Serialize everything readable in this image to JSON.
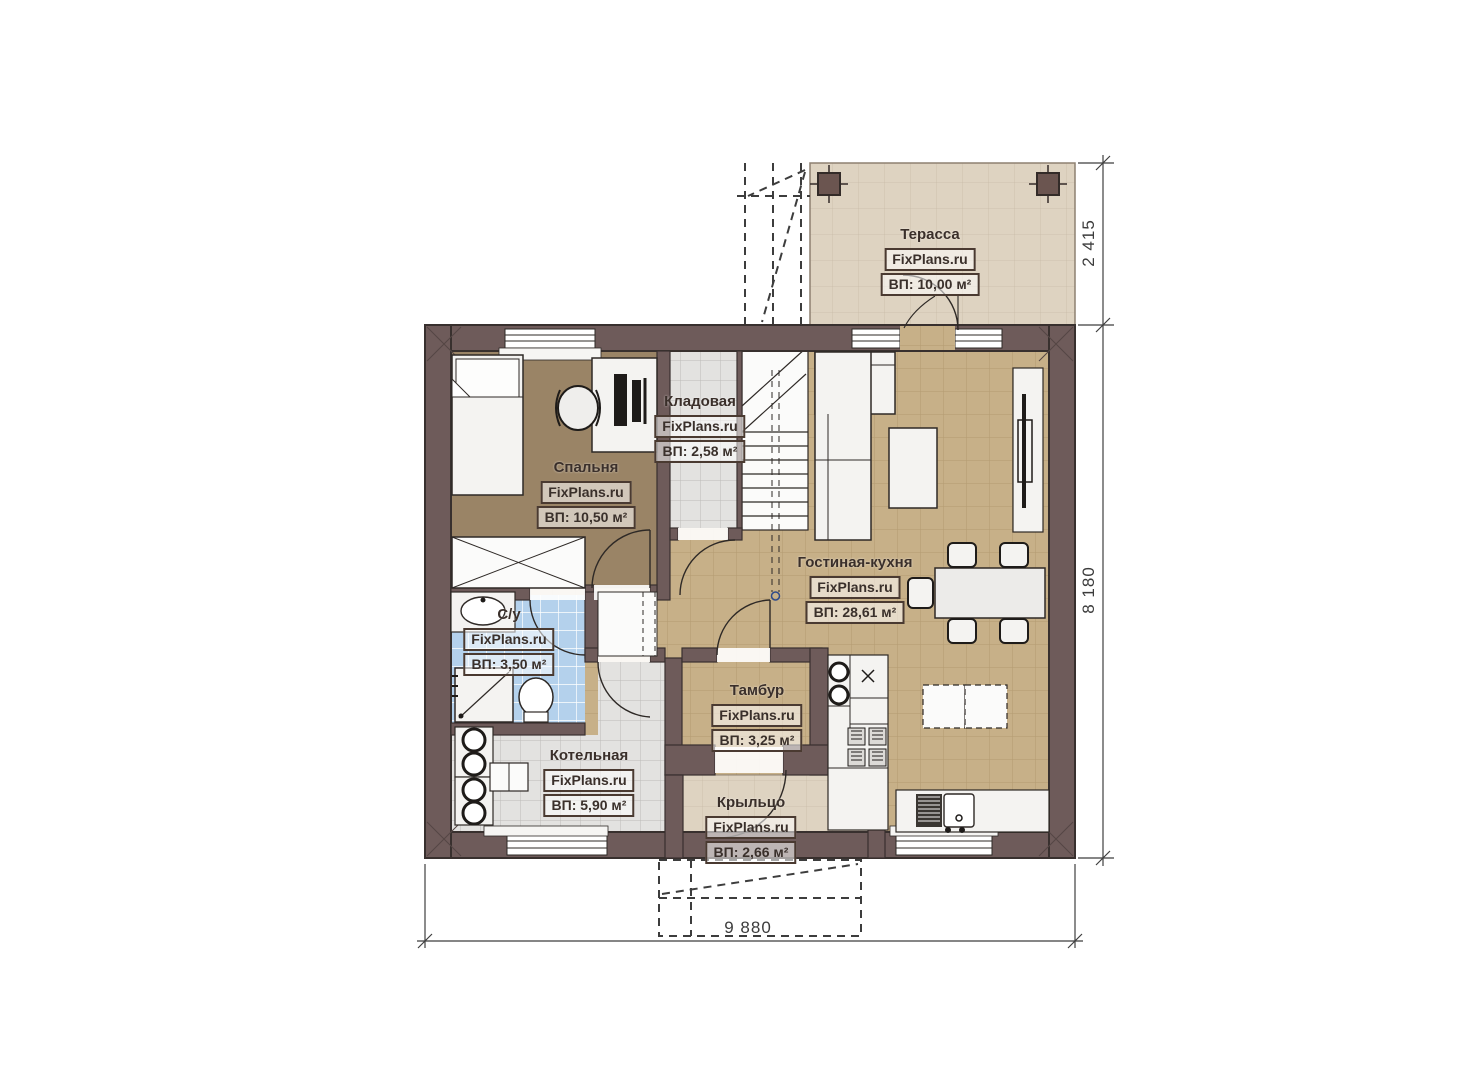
{
  "brand": "FixPlans.ru",
  "rooms": [
    {
      "id": "terrace",
      "name": "Терасса",
      "brand": "FixPlans.ru",
      "area": "ВП: 10,00 м²"
    },
    {
      "id": "storage",
      "name": "Кладовая",
      "brand": "FixPlans.ru",
      "area": "ВП: 2,58 м²"
    },
    {
      "id": "bedroom",
      "name": "Спальня",
      "brand": "FixPlans.ru",
      "area": "ВП: 10,50 м²"
    },
    {
      "id": "living_kitchen",
      "name": "Гостиная-кухня",
      "brand": "FixPlans.ru",
      "area": "ВП: 28,61 м²"
    },
    {
      "id": "bathroom",
      "name": "С/у",
      "brand": "FixPlans.ru",
      "area": "ВП: 3,50 м²"
    },
    {
      "id": "vestibule",
      "name": "Тамбур",
      "brand": "FixPlans.ru",
      "area": "ВП: 3,25 м²"
    },
    {
      "id": "boiler_room",
      "name": "Котельная",
      "brand": "FixPlans.ru",
      "area": "ВП: 5,90 м²"
    },
    {
      "id": "porch",
      "name": "Крыльцо",
      "brand": "FixPlans.ru",
      "area": "ВП: 2,66 м²"
    }
  ],
  "dimensions": {
    "terrace_depth": "2 415",
    "right_height": "8 180",
    "bottom_width": "9 880"
  },
  "colors": {
    "wall": "#6e5b5a",
    "wall_outline": "#38302e",
    "floor_tan": "#c7b088",
    "floor_bedroom": "#9a8466",
    "floor_grey": "#e3e2e0",
    "floor_blue": "#b4d1ec",
    "floor_beige": "#ded3c1",
    "furniture": "#f4f3f1",
    "dimension_line": "#3f3f3f"
  }
}
